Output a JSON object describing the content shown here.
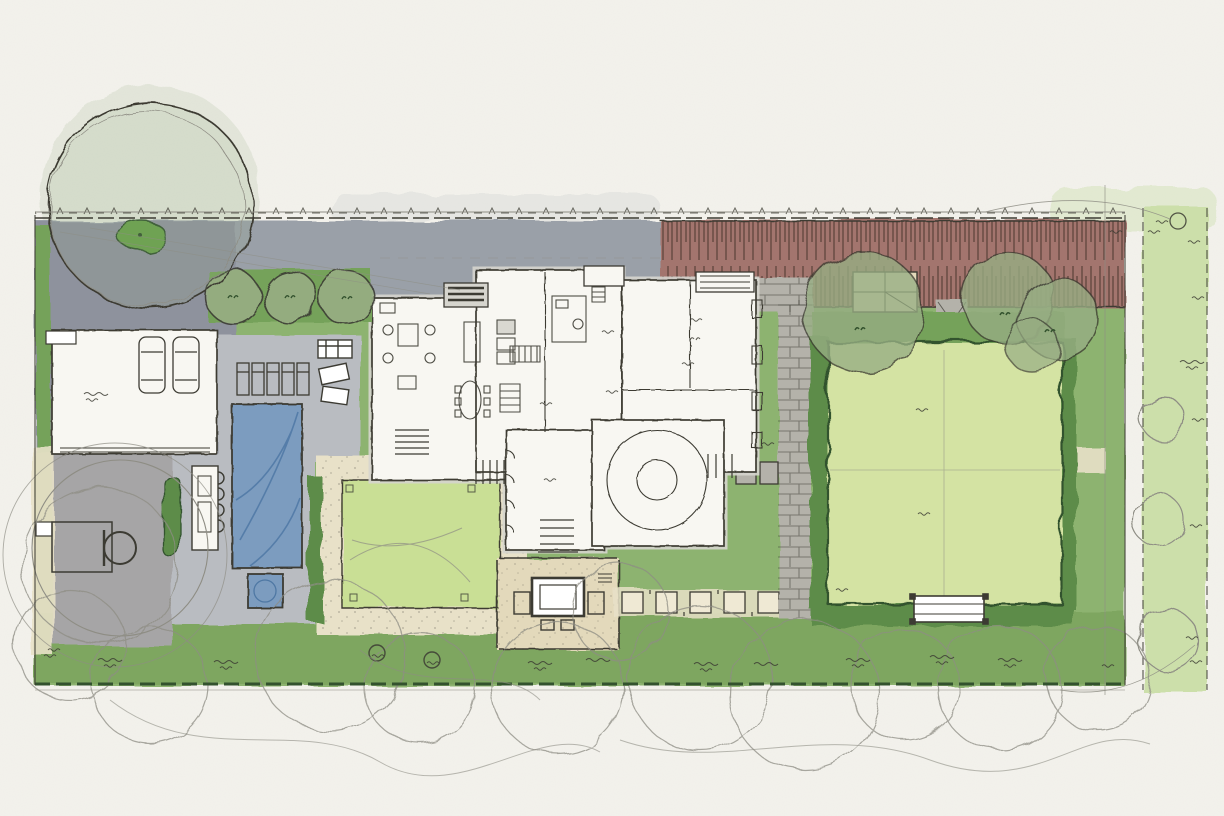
{
  "document": {
    "title": "Residential landscape site plan",
    "medium": "watercolor and ink concept sketch, plan view",
    "annotations_note": "all handwritten labels are illegible scribbles; no legible text appears in the drawing"
  },
  "palette": {
    "paper": "#f3f2ec",
    "baseGreen": "#8db370",
    "bandGreen": "#7aa15c",
    "bedGreen": "#74a25a",
    "hedgeFill": "#5d8c49",
    "hedgeInk": "#33522e",
    "lawnLight": "#d4e3a3",
    "lawnCourtyard": "#c9df95",
    "stripGreen": "#ccdfaa",
    "sageTree": "#97ad83",
    "brightGreen": "#67a04b",
    "laneGray": "#9aa0a8",
    "motorGray": "#8e929d",
    "deckGray": "#b9bcc1",
    "courtGray": "#a6a5a6",
    "paverGray": "#b4b2aa",
    "brickRed": "#a3756e",
    "brickDark": "#5e443c",
    "tanPath": "#e8e1c8",
    "terraceTan": "#e3d9bb",
    "stoneTan": "#efe9d4",
    "poolBlue": "#7b9cbf",
    "poolDark": "#4f78a4",
    "houseWhite": "#f8f7f2",
    "roofShadow": "#d6d5ce",
    "ink": "#3c3b33",
    "pencil": "#8e8d84",
    "white": "#ffffff"
  },
  "elements": [
    {
      "name": "property-boundary",
      "type": "dashed line with fence ticks"
    },
    {
      "name": "rear-lane-paving",
      "type": "gray drive band along top"
    },
    {
      "name": "motor-court",
      "type": "gray paved court, top left"
    },
    {
      "name": "specimen-tree-canopy",
      "type": "large pencil-outline tree over motor court"
    },
    {
      "name": "planting-island",
      "type": "small green island in motor court"
    },
    {
      "name": "garage",
      "type": "two-car garage with parked cars"
    },
    {
      "name": "basketball-half-court",
      "type": "gray court with key and hoop"
    },
    {
      "name": "outdoor-kitchen",
      "type": "counter with scalloped grill edge"
    },
    {
      "name": "hedge-screen",
      "type": "dark clipped hedge strips"
    },
    {
      "name": "swimming-pool",
      "type": "blue rectangular pool"
    },
    {
      "name": "spa",
      "type": "small square spa"
    },
    {
      "name": "lounge-chairs",
      "type": "five chaises on pool deck"
    },
    {
      "name": "lounge-seating",
      "type": "two outdoor sofas"
    },
    {
      "name": "street-trees",
      "type": "three round trees on entry bed"
    },
    {
      "name": "entry-trellis",
      "type": "slatted arbor at front door"
    },
    {
      "name": "residence-floor-plan",
      "type": "white house footprint with rooms, furniture, rotunda terrace"
    },
    {
      "name": "courtyard-lawn",
      "type": "lime lawn panel framed by gravel path"
    },
    {
      "name": "gravel-path",
      "type": "decomposed granite frame with dots"
    },
    {
      "name": "fire-pit-terrace",
      "type": "tan terrace with fire table and seats"
    },
    {
      "name": "stepping-stone-path",
      "type": "square pavers running east"
    },
    {
      "name": "stone-paver-walk",
      "type": "gray paver walk, L-shaped"
    },
    {
      "name": "garden-shed",
      "type": "small tan structure under trees"
    },
    {
      "name": "great-lawn",
      "type": "large light lawn with hedge border"
    },
    {
      "name": "garden-bench",
      "type": "bench at lawn south edge"
    },
    {
      "name": "shade-trees",
      "type": "sage watercolor canopies, east garden"
    },
    {
      "name": "neighbor-structure-roof",
      "type": "red-brown hatched band along top right"
    },
    {
      "name": "side-yard-strip",
      "type": "pale green planting strip at far right with outline trees"
    },
    {
      "name": "annotation-scribbles",
      "type": "about 30 illegible handwritten notes, circled markers 2, 3, 6"
    },
    {
      "name": "pencil-tree-outlines",
      "type": "loose canopy circles along bottom edge"
    }
  ]
}
